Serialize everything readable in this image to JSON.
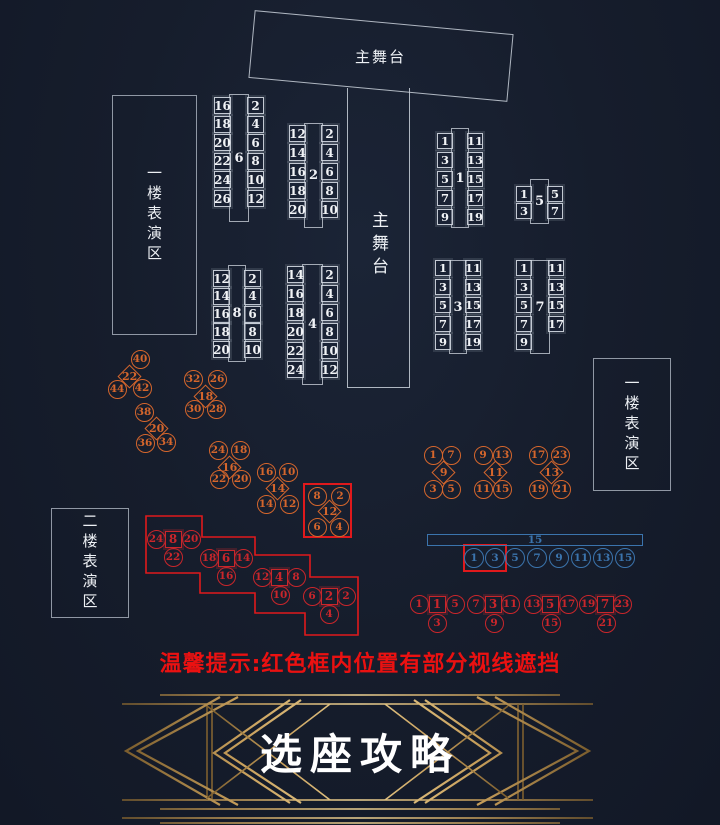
{
  "colors": {
    "orange": "#d5662c",
    "red": "#c9262b",
    "red-frame": "#e0191c",
    "blue": "#3b74ad",
    "gold": "#c29b59",
    "warning": "#ea1111",
    "seat-text": "#f1f3f6"
  },
  "stages": {
    "top": {
      "label": "主舞台"
    },
    "center": {
      "label": "主舞台"
    }
  },
  "zones": [
    {
      "label": "一楼表演区"
    },
    {
      "label": "一楼表演区"
    },
    {
      "label": "二楼表演区"
    }
  ],
  "tables": [
    {
      "num": "6",
      "rect": [
        229,
        94,
        20,
        128
      ],
      "seat": 17,
      "y0": 97,
      "dy": 18.6,
      "left": [
        "16",
        "18",
        "20",
        "22",
        "24",
        "26"
      ],
      "right": [
        "2",
        "4",
        "6",
        "8",
        "10",
        "12"
      ]
    },
    {
      "num": "2",
      "rect": [
        304,
        123,
        19,
        105
      ],
      "seat": 17,
      "y0": 125,
      "dy": 19,
      "left": [
        "12",
        "14",
        "16",
        "18",
        "20"
      ],
      "right": [
        "2",
        "4",
        "6",
        "8",
        "10"
      ]
    },
    {
      "num": "1",
      "rect": [
        451,
        128,
        18,
        100
      ],
      "seat": 16,
      "y0": 133,
      "dy": 19,
      "left": [
        "1",
        "3",
        "5",
        "7",
        "9"
      ],
      "right": [
        "11",
        "13",
        "15",
        "17",
        "19"
      ]
    },
    {
      "num": "5",
      "rect": [
        530,
        179,
        19,
        45
      ],
      "seat": 16,
      "y0": 186,
      "dy": 17,
      "left": [
        "1",
        "3"
      ],
      "right": [
        "5",
        "7"
      ]
    },
    {
      "num": "8",
      "rect": [
        228,
        265,
        18,
        97
      ],
      "seat": 17,
      "y0": 270,
      "dy": 17.8,
      "left": [
        "12",
        "14",
        "16",
        "18",
        "20"
      ],
      "right": [
        "2",
        "4",
        "6",
        "8",
        "10"
      ]
    },
    {
      "num": "4",
      "rect": [
        302,
        264,
        21,
        121
      ],
      "seat": 17,
      "y0": 266,
      "dy": 19,
      "left": [
        "14",
        "16",
        "18",
        "20",
        "22",
        "24"
      ],
      "right": [
        "2",
        "4",
        "6",
        "8",
        "10",
        "12"
      ]
    },
    {
      "num": "3",
      "rect": [
        449,
        260,
        18,
        94
      ],
      "seat": 16,
      "y0": 260,
      "dy": 18.6,
      "left": [
        "1",
        "3",
        "5",
        "7",
        "9"
      ],
      "right": [
        "11",
        "13",
        "15",
        "17",
        "19"
      ]
    },
    {
      "num": "7",
      "rect": [
        530,
        260,
        20,
        94
      ],
      "seat": 16,
      "y0": 260,
      "dy": 18.6,
      "left": [
        "1",
        "3",
        "5",
        "7",
        "9"
      ],
      "right": [
        "11",
        "13",
        "15",
        "17"
      ]
    }
  ],
  "diamond_clusters": [
    {
      "num": "22",
      "cx": 129,
      "cy": 376,
      "sats": [
        [
          11,
          -17,
          "40"
        ],
        [
          -12,
          13,
          "44"
        ],
        [
          13,
          12,
          "42"
        ]
      ]
    },
    {
      "num": "18",
      "cx": 205,
      "cy": 396,
      "sats": [
        [
          -12,
          -17,
          "32"
        ],
        [
          12,
          -17,
          "26"
        ],
        [
          -11,
          13,
          "30"
        ],
        [
          11,
          13,
          "28"
        ]
      ]
    },
    {
      "num": "20",
      "cx": 156,
      "cy": 428,
      "sats": [
        [
          -12,
          -16,
          "38"
        ],
        [
          -11,
          15,
          "36"
        ],
        [
          10,
          14,
          "34"
        ]
      ]
    },
    {
      "num": "16",
      "cx": 229,
      "cy": 467,
      "sats": [
        [
          -11,
          -17,
          "24"
        ],
        [
          11,
          -17,
          "18"
        ],
        [
          -10,
          12,
          "22"
        ],
        [
          12,
          12,
          "20"
        ]
      ]
    },
    {
      "num": "14",
      "cx": 277,
      "cy": 488,
      "sats": [
        [
          -11,
          -16,
          "16"
        ],
        [
          11,
          -16,
          "10"
        ],
        [
          -11,
          16,
          "14"
        ],
        [
          12,
          16,
          "12"
        ]
      ]
    },
    {
      "num": "12",
      "cx": 329,
      "cy": 511,
      "sats": [
        [
          -12,
          -15,
          "8"
        ],
        [
          11,
          -15,
          "2"
        ],
        [
          -12,
          16,
          "6"
        ],
        [
          10,
          16,
          "4"
        ]
      ]
    },
    {
      "num": "9",
      "cx": 443,
      "cy": 472,
      "sats": [
        [
          -10,
          -17,
          "1"
        ],
        [
          8,
          -17,
          "7"
        ],
        [
          -10,
          17,
          "3"
        ],
        [
          8,
          17,
          "5"
        ]
      ]
    },
    {
      "num": "11",
      "cx": 495,
      "cy": 472,
      "sats": [
        [
          -12,
          -17,
          "9"
        ],
        [
          7,
          -17,
          "13"
        ],
        [
          -12,
          17,
          "11"
        ],
        [
          7,
          17,
          "15"
        ]
      ]
    },
    {
      "num": "13",
      "cx": 551,
      "cy": 472,
      "sats": [
        [
          -13,
          -17,
          "17"
        ],
        [
          9,
          -17,
          "23"
        ],
        [
          -13,
          17,
          "19"
        ],
        [
          10,
          17,
          "21"
        ]
      ]
    }
  ],
  "square_clusters": [
    {
      "num": "8",
      "cx": 173,
      "cy": 539,
      "sats": [
        [
          -17,
          0,
          "24"
        ],
        [
          18,
          0,
          "20"
        ],
        [
          0,
          18,
          "22"
        ]
      ]
    },
    {
      "num": "6",
      "cx": 226,
      "cy": 558,
      "sats": [
        [
          -17,
          0,
          "18"
        ],
        [
          17,
          0,
          "14"
        ],
        [
          0,
          18,
          "16"
        ]
      ]
    },
    {
      "num": "4",
      "cx": 279,
      "cy": 577,
      "sats": [
        [
          -17,
          0,
          "12"
        ],
        [
          17,
          0,
          "8"
        ],
        [
          1,
          18,
          "10"
        ]
      ]
    },
    {
      "num": "2",
      "cx": 329,
      "cy": 596,
      "sats": [
        [
          -17,
          0,
          "6"
        ],
        [
          17,
          0,
          "2"
        ],
        [
          0,
          18,
          "4"
        ]
      ]
    },
    {
      "num": "1",
      "cx": 437,
      "cy": 604,
      "sats": [
        [
          -18,
          0,
          "1"
        ],
        [
          18,
          0,
          "5"
        ],
        [
          0,
          19,
          "3"
        ]
      ]
    },
    {
      "num": "3",
      "cx": 493,
      "cy": 604,
      "sats": [
        [
          -17,
          0,
          "7"
        ],
        [
          17,
          0,
          "11"
        ],
        [
          1,
          19,
          "9"
        ]
      ]
    },
    {
      "num": "5",
      "cx": 550,
      "cy": 604,
      "sats": [
        [
          -17,
          0,
          "13"
        ],
        [
          18,
          0,
          "17"
        ],
        [
          1,
          19,
          "15"
        ]
      ]
    },
    {
      "num": "7",
      "cx": 605,
      "cy": 604,
      "sats": [
        [
          -17,
          0,
          "19"
        ],
        [
          17,
          0,
          "23"
        ],
        [
          1,
          19,
          "21"
        ]
      ]
    }
  ],
  "blue_row": {
    "bar": {
      "label": "15",
      "x": 427,
      "y": 534,
      "w": 216,
      "h": 12
    },
    "circle_y": 558,
    "circles": [
      {
        "x": 474,
        "label": "1"
      },
      {
        "x": 495,
        "label": "3"
      },
      {
        "x": 515,
        "label": "5"
      },
      {
        "x": 537,
        "label": "7"
      },
      {
        "x": 559,
        "label": "9"
      },
      {
        "x": 581,
        "label": "11"
      },
      {
        "x": 603,
        "label": "13"
      },
      {
        "x": 625,
        "label": "15"
      }
    ]
  },
  "red_frames": [
    {
      "x": 303,
      "y": 483,
      "w": 49,
      "h": 55
    },
    {
      "x": 463,
      "y": 544,
      "w": 44,
      "h": 28
    }
  ],
  "obstructed_polygon": "146,516 202,516 202,537 255,537 255,555 310,555 310,577 358,577 358,635 305,635 305,613 255,613 255,593 200,593 200,573 146,573",
  "warning": "温馨提示:红色框内位置有部分视线遮挡",
  "banner": {
    "title": "选座攻略"
  }
}
